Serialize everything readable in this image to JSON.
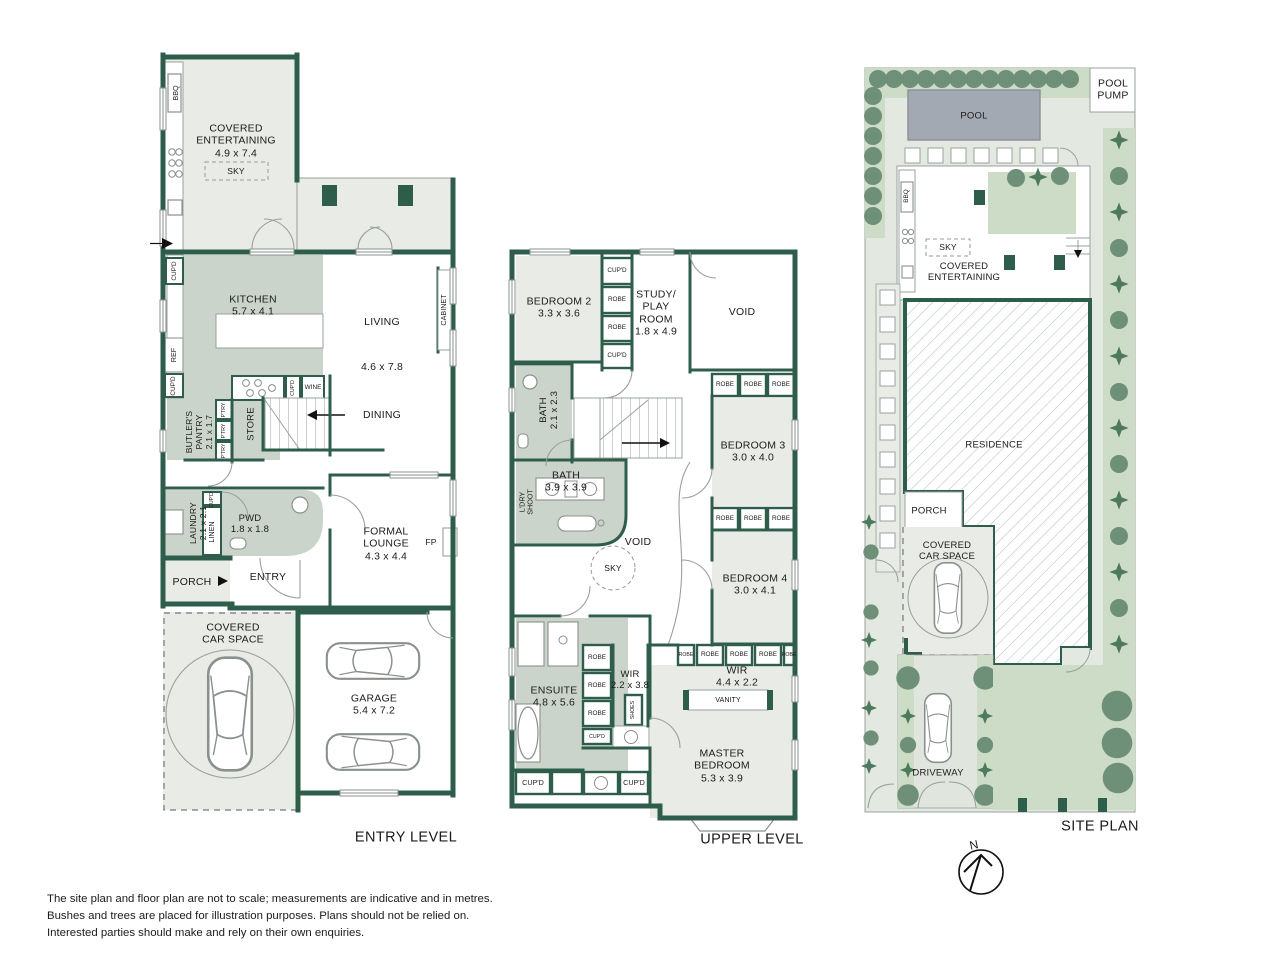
{
  "palette": {
    "wall_green": "#2e5e4b",
    "room_gray": "#e9ebe7",
    "room_sage": "#cbd4cb",
    "site_ground": "#e3e9e1",
    "garden_green": "#ccdcc6",
    "tree_green": "#6f9078",
    "shrub_green": "#4d7a5f",
    "pool_gray": "#a3a9b2"
  },
  "entry_level": {
    "title": "ENTRY LEVEL",
    "covered_entertaining": "COVERED\nENTERTAINING\n4.9 x 7.4",
    "sky": "SKY",
    "bbq": "BBQ",
    "cupd": "CUP'D",
    "kitchen": "KITCHEN\n5.7 x 4.1",
    "living": "LIVING",
    "living_dims": "4.6 x 7.8",
    "dining": "DINING",
    "cabinet": "CABINET",
    "ref": "REF",
    "butlers_pantry": "BUTLER'S\nPANTRY\n2.1 x 1.7",
    "ptry": "P'TRY",
    "store": "STORE",
    "wine": "WINE",
    "laundry": "LAUNDRY\n2.1 x 2.1",
    "linen": "LINEN",
    "pwd": "PWD\n1.8 x 1.8",
    "porch": "PORCH",
    "entry": "ENTRY",
    "formal_lounge": "FORMAL\nLOUNGE\n4.3 x 4.4",
    "fp": "FP",
    "covered_car_space": "COVERED\nCAR SPACE",
    "garage": "GARAGE\n5.4 x 7.2"
  },
  "upper_level": {
    "title": "UPPER LEVEL",
    "bedroom2": "BEDROOM 2\n3.3 x 3.6",
    "study": "STUDY/\nPLAY\nROOM\n1.8 x 4.9",
    "void": "VOID",
    "sky": "SKY",
    "bath2": "BATH\n2.1 x 2.3",
    "bath": "BATH\n3.9 x 3.9",
    "ldry_shoot": "L'DRY\nSHOOT",
    "robe": "ROBE",
    "cupd": "CUP'D",
    "bedroom3": "BEDROOM 3\n3.0 x 4.0",
    "bedroom4": "BEDROOM 4\n3.0 x 4.1",
    "ensuite": "ENSUITE\n4.8 x 5.6",
    "wir": "WIR\n2.2 x 3.8",
    "wir_master": "WIR\n4.4 x 2.2",
    "shoes": "SHOES",
    "vanity": "VANITY",
    "master_bedroom": "MASTER\nBEDROOM\n5.3 x 3.9"
  },
  "site_plan": {
    "title": "SITE PLAN",
    "pool": "POOL",
    "pool_pump": "POOL\nPUMP",
    "bbq": "BBQ",
    "sky": "SKY",
    "covered_entertaining": "COVERED\nENTERTAINING",
    "residence": "RESIDENCE",
    "porch": "PORCH",
    "covered_car_space": "COVERED\nCAR SPACE",
    "driveway": "DRIVEWAY"
  },
  "compass": {
    "north": "N"
  },
  "disclaimer": {
    "line1": "The site plan and floor plan are not to scale; measurements are indicative and in metres.",
    "line2": "Bushes and trees are placed for illustration purposes. Plans should not be relied on.",
    "line3": "Interested parties should make and rely on their own enquiries."
  }
}
